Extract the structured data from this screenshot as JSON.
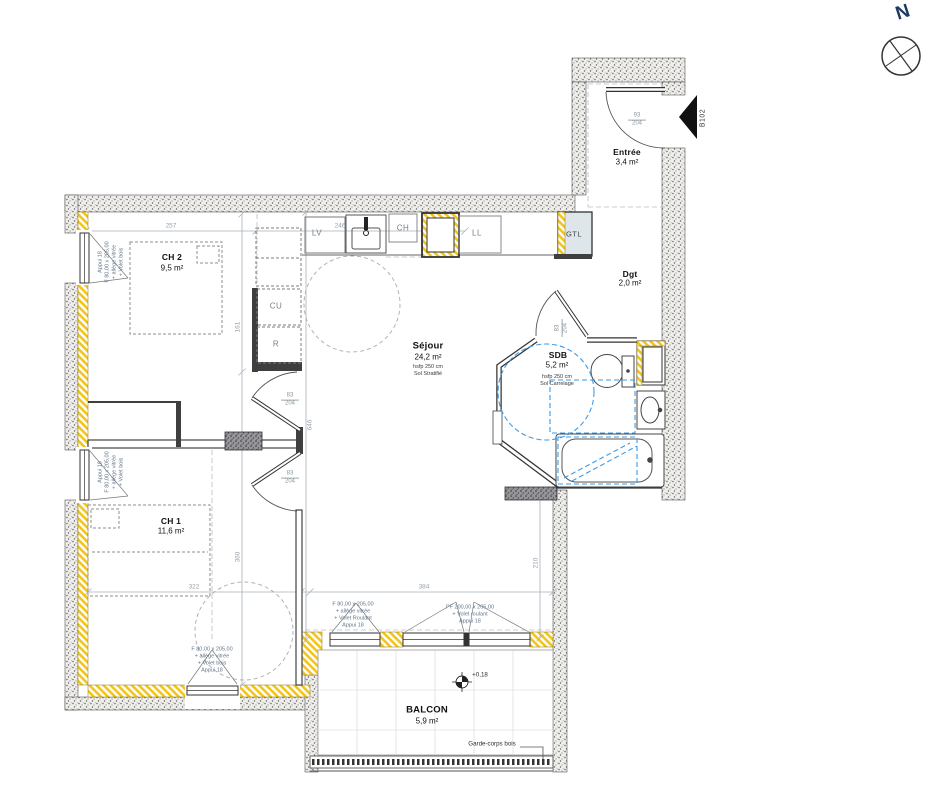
{
  "compass": {
    "north": "N"
  },
  "unit": {
    "code": "B102"
  },
  "rooms": {
    "ch2": {
      "name": "CH 2",
      "area": "9,5 m²"
    },
    "ch1": {
      "name": "CH 1",
      "area": "11,6 m²"
    },
    "sejour": {
      "name": "Séjour",
      "area": "24,2 m²",
      "ceiling": "hsfp 250 cm",
      "floor": "Sol Stratifié"
    },
    "sdb": {
      "name": "SDB",
      "area": "5,2 m²",
      "ceiling": "hsfp 250 cm",
      "floor": "Sol Carrelage"
    },
    "entree": {
      "name": "Entrée",
      "area": "3,4 m²"
    },
    "dgt": {
      "name": "Dgt",
      "area": "2,0 m²"
    },
    "balcon": {
      "name": "BALCON",
      "area": "5,9 m²"
    }
  },
  "kitchen": {
    "lv": "LV",
    "ch": "CH",
    "ll": "LL",
    "gtl": "GTL",
    "cu": "CU",
    "r": "R"
  },
  "doors": {
    "entry": {
      "width": "93",
      "height": "204"
    },
    "interior": {
      "width": "83",
      "height": "204"
    }
  },
  "dimensions": {
    "d257": "257",
    "d246": "246",
    "d161": "161",
    "d646": "646",
    "d322": "322",
    "d360": "360",
    "d384": "384",
    "d210": "210"
  },
  "window_labels": {
    "ch2_left": {
      "l1": "Appui 18",
      "l2": "F 80,00 x 205,00",
      "l3": "+ allège vitrée",
      "l4": "+ Volet bois"
    },
    "ch1_left": {
      "l1": "Appui 18",
      "l2": "F 80,00 x 205,00",
      "l3": "+ allège vitrée",
      "l4": "+ Volet bois"
    },
    "ch1_bottom": {
      "l1": "F 80,00 x 205,00",
      "l2": "+ allège vitrée",
      "l3": "+ Volet bois",
      "l4": "Appui 18"
    },
    "balcony_left": {
      "l1": "F 80,00 x 205,00",
      "l2": "+ allège vitrée",
      "l3": "+ Volet Roulant",
      "l4": "Appui 18"
    },
    "balcony_main": {
      "l1": "PF 200,00 x 205,00",
      "l2": "+ Volet roulant",
      "l3": "Appui 18"
    }
  },
  "balcony": {
    "railing": "Garde-corps bois",
    "level": "+0,18"
  },
  "colors": {
    "insulation": "#f3c51c",
    "accessibility": "#3d9be9",
    "wall": "#3f3f3f"
  }
}
